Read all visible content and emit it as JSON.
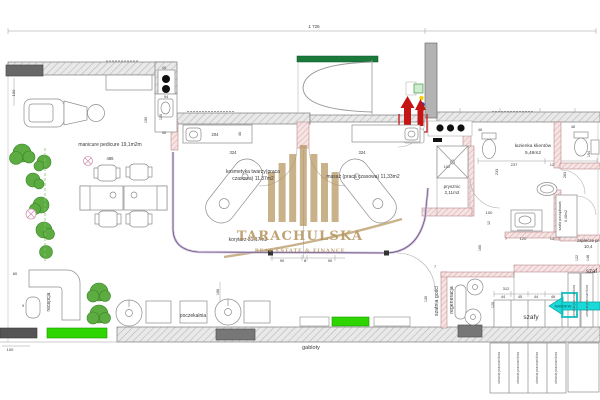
{
  "colors": {
    "text": "#3a3a3a",
    "dim_text": "#4a4a4a",
    "wall_hatch": "#e9e9e9",
    "partition_pink": "#f6e3e3",
    "accent_green": "#2ed500",
    "lintel_green": "#1a7a3c",
    "entry_red": "#c41414",
    "vent_cyan": "#1ad9d9",
    "vent_text": "#035c5c",
    "watermark_gold": "#b5945e",
    "tree_green": "#55a838",
    "track_purple": "#cbbadd",
    "window_gray": "#686868"
  },
  "labels": [
    {
      "n": "dim-total-width",
      "t": "1 726",
      "x": 314,
      "y": 28,
      "s": 4.5
    },
    {
      "n": "room-label-manicure",
      "t": "manicure pedicure 19,1m2m",
      "x": 110,
      "y": 146,
      "s": 5
    },
    {
      "n": "dim-486",
      "t": "486",
      "x": 110,
      "y": 160,
      "s": 4.2
    },
    {
      "n": "dim-100-left",
      "t": "100",
      "x": 15,
      "y": 93,
      "s": 4,
      "r": -90
    },
    {
      "n": "dim-40-top",
      "t": "40",
      "x": 164,
      "y": 69,
      "s": 4
    },
    {
      "n": "dim-94",
      "t": "94",
      "x": 166,
      "y": 98,
      "s": 3.8
    },
    {
      "n": "dim-120-left",
      "t": "120",
      "x": 162,
      "y": 117,
      "s": 3.8,
      "r": -90
    },
    {
      "n": "dim-190",
      "t": "190",
      "x": 147,
      "y": 120,
      "s": 3.8,
      "r": -90
    },
    {
      "n": "dim-40-mid",
      "t": "40",
      "x": 164,
      "y": 134,
      "s": 4
    },
    {
      "n": "dim-204",
      "t": "204",
      "x": 215,
      "y": 136,
      "s": 4.2
    },
    {
      "n": "dim-40-counter",
      "t": "40",
      "x": 241,
      "y": 134,
      "s": 4,
      "r": -90
    },
    {
      "n": "dim-324-left",
      "t": "324",
      "x": 233,
      "y": 154,
      "s": 4.2
    },
    {
      "n": "dim-324-right",
      "t": "324",
      "x": 362,
      "y": 154,
      "s": 4.2
    },
    {
      "n": "room-label-kosmetyka-line1",
      "t": "kosmetyka twarzy(praca",
      "x": 253,
      "y": 173,
      "s": 5
    },
    {
      "n": "room-label-kosmetyka-line2",
      "t": "czasowa) 11,37m2",
      "x": 253,
      "y": 180,
      "s": 5
    },
    {
      "n": "room-label-masaz",
      "t": "masaż (praca czasowa) 11,33m2",
      "x": 363,
      "y": 178,
      "s": 5
    },
    {
      "n": "room-label-lazienka-line1",
      "t": "łazienka klientów",
      "x": 533,
      "y": 147,
      "s": 4.8
    },
    {
      "n": "room-label-lazienka-line2",
      "t": "5,46m2",
      "x": 533,
      "y": 154,
      "s": 4.8
    },
    {
      "n": "dim-48-left-wc",
      "t": "48",
      "x": 480,
      "y": 131,
      "s": 3.6
    },
    {
      "n": "dim-48-right-wc",
      "t": "48",
      "x": 573,
      "y": 128,
      "s": 3.6
    },
    {
      "n": "dim-102",
      "t": "102",
      "x": 447,
      "y": 168,
      "s": 4
    },
    {
      "n": "room-label-prysznic-line1",
      "t": "prysznic",
      "x": 452,
      "y": 188,
      "s": 4.6
    },
    {
      "n": "room-label-prysznic-line2",
      "t": "2,11m2",
      "x": 452,
      "y": 194,
      "s": 4.6
    },
    {
      "n": "dim-237",
      "t": "237",
      "x": 514,
      "y": 166,
      "s": 4
    },
    {
      "n": "dim-12-lazienka",
      "t": "12",
      "x": 552,
      "y": 166,
      "s": 4
    },
    {
      "n": "dim-233",
      "t": "233",
      "x": 498,
      "y": 172,
      "s": 3.8,
      "r": -90
    },
    {
      "n": "dim-263",
      "t": "263",
      "x": 566,
      "y": 175,
      "s": 3.8,
      "r": -90
    },
    {
      "n": "dim-154",
      "t": "154",
      "x": 590,
      "y": 154,
      "s": 3.8,
      "r": -90
    },
    {
      "n": "dim-100-lazienka",
      "t": "100",
      "x": 489,
      "y": 214,
      "s": 4
    },
    {
      "n": "dim-12-small",
      "t": "12",
      "x": 490,
      "y": 223,
      "s": 3.6,
      "r": -90
    },
    {
      "n": "dim-160",
      "t": "160",
      "x": 481,
      "y": 248,
      "s": 3.8,
      "r": -90
    },
    {
      "n": "dim-7-aneks",
      "t": "7",
      "x": 506,
      "y": 240,
      "s": 3.8
    },
    {
      "n": "dim-120-aneks",
      "t": "120",
      "x": 523,
      "y": 240,
      "s": 4
    },
    {
      "n": "dim-12-aneks",
      "t": "12",
      "x": 552,
      "y": 240,
      "s": 4
    },
    {
      "n": "room-label-szafa-porzadkowa",
      "t": "szafa porządkowa",
      "x": 561,
      "y": 216,
      "s": 3.6,
      "r": -90
    },
    {
      "n": "room-label-szafa-porzadkowa-area",
      "t": "0,48m2",
      "x": 567,
      "y": 216,
      "s": 3.6,
      "r": -90
    },
    {
      "n": "room-label-zaplecze-line1",
      "t": "zaplecze pr",
      "x": 577,
      "y": 242,
      "s": 4.3,
      "a": "start"
    },
    {
      "n": "room-label-zaplecze-line2",
      "t": "10,4",
      "x": 584,
      "y": 248,
      "s": 4.3,
      "a": "start"
    },
    {
      "n": "dim-122",
      "t": "122",
      "x": 578,
      "y": 258,
      "s": 3.8,
      "r": -90
    },
    {
      "n": "dim-148",
      "t": "148",
      "x": 589,
      "y": 258,
      "s": 3.8,
      "r": -90
    },
    {
      "n": "room-label-szafy-right",
      "t": "szaf",
      "x": 586,
      "y": 273,
      "s": 6,
      "a": "start"
    },
    {
      "n": "dim-130",
      "t": "130",
      "x": 427,
      "y": 299,
      "s": 3.8,
      "r": -90
    },
    {
      "n": "dim-7-szatnia",
      "t": "7",
      "x": 435,
      "y": 268,
      "s": 3.8
    },
    {
      "n": "dim-312",
      "t": "312",
      "x": 506,
      "y": 290,
      "s": 4
    },
    {
      "n": "dim-44-1",
      "t": "44",
      "x": 503,
      "y": 298,
      "s": 3.8
    },
    {
      "n": "dim-45",
      "t": "45",
      "x": 520,
      "y": 298,
      "s": 3.8
    },
    {
      "n": "dim-44-2",
      "t": "44",
      "x": 536,
      "y": 298,
      "s": 3.8
    },
    {
      "n": "dim-46",
      "t": "46",
      "x": 553,
      "y": 298,
      "s": 3.8
    },
    {
      "n": "dim-120-szafy",
      "t": "120",
      "x": 494,
      "y": 305,
      "s": 3.8,
      "r": -90
    },
    {
      "n": "room-label-szafy",
      "t": "szafy",
      "x": 531,
      "y": 319,
      "s": 6.5
    },
    {
      "n": "room-label-szatnia",
      "t": "szatnia gości",
      "x": 438,
      "y": 301,
      "s": 5.2,
      "r": -90
    },
    {
      "n": "room-label-regeneracja",
      "t": "regeneracja",
      "x": 453,
      "y": 300,
      "s": 5.2,
      "r": -90
    },
    {
      "n": "wardrobe-label-1",
      "t": "ubrania pracowników",
      "x": 575,
      "y": 301,
      "s": 3.4,
      "r": -90,
      "c": "#555555"
    },
    {
      "n": "wardrobe-label-2",
      "t": "ubrania pracowników",
      "x": 588,
      "y": 301,
      "s": 3.4,
      "r": -90,
      "c": "#555555"
    },
    {
      "n": "wardrobe-label-3",
      "t": "ubrania pracowników",
      "x": 500,
      "y": 368,
      "s": 3.4,
      "r": -90,
      "c": "#555555"
    },
    {
      "n": "wardrobe-label-4",
      "t": "ubrania pracowników",
      "x": 519,
      "y": 368,
      "s": 3.4,
      "r": -90,
      "c": "#555555"
    },
    {
      "n": "wardrobe-label-5",
      "t": "ubrania pracowników",
      "x": 538,
      "y": 368,
      "s": 3.4,
      "r": -90,
      "c": "#555555"
    },
    {
      "n": "wardrobe-label-6",
      "t": "ubrania pracowników",
      "x": 557,
      "y": 368,
      "s": 3.4,
      "r": -90,
      "c": "#555555"
    },
    {
      "n": "room-label-korytarz",
      "t": "korytarz 31,17m2",
      "x": 248,
      "y": 241,
      "s": 5
    },
    {
      "n": "dim-90-left",
      "t": "90",
      "x": 282,
      "y": 262,
      "s": 4
    },
    {
      "n": "dim-8",
      "t": "8",
      "x": 305,
      "y": 262,
      "s": 4
    },
    {
      "n": "dim-90-right",
      "t": "90",
      "x": 330,
      "y": 262,
      "s": 4
    },
    {
      "n": "room-label-poczekalnia",
      "t": "poczekalnia",
      "x": 193,
      "y": 317,
      "s": 5
    },
    {
      "n": "dim-166",
      "t": "166",
      "x": 219,
      "y": 292,
      "s": 3.8,
      "r": -90
    },
    {
      "n": "room-label-recepcja",
      "t": "recepcja",
      "x": 50,
      "y": 302,
      "s": 5,
      "r": -90
    },
    {
      "n": "dim-80",
      "t": "80",
      "x": 15,
      "y": 275,
      "s": 4
    },
    {
      "n": "dim-9",
      "t": "9",
      "x": 23,
      "y": 307,
      "s": 3.8
    },
    {
      "n": "dim-100-bottom",
      "t": "100",
      "x": 10,
      "y": 351,
      "s": 4
    },
    {
      "n": "room-label-gabloty",
      "t": "gabloty",
      "x": 311,
      "y": 349,
      "s": 5.5
    },
    {
      "n": "nawiew-label",
      "t": "NAWIEW",
      "x": 563,
      "y": 307.5,
      "s": 4,
      "c": "#035c5c"
    },
    {
      "n": "watermark-brand",
      "t": "TARACHULSKA",
      "x": 300,
      "y": 240,
      "s": 13,
      "f": 1,
      "ls": 1.2,
      "c": "#b5945e",
      "o": 0.85
    },
    {
      "n": "watermark-tagline",
      "t": "REAL ESTATE & FINANCE",
      "x": 300,
      "y": 252,
      "s": 5,
      "f": 1,
      "ls": 0.8,
      "c": "#b5945e",
      "o": 0.85
    }
  ]
}
